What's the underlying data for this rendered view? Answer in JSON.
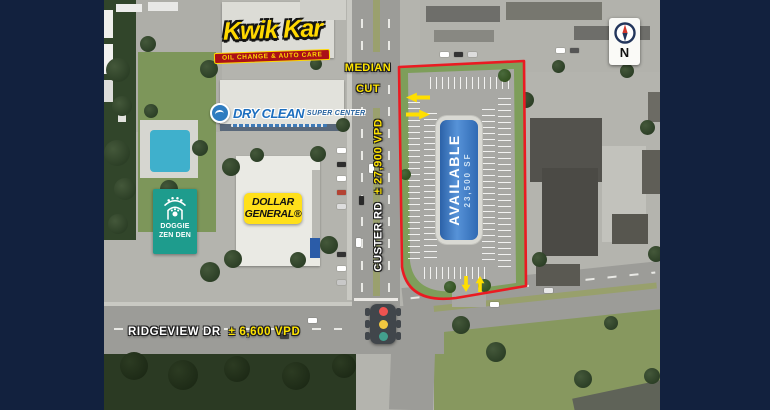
{
  "map_labels": {
    "kwik_kar": {
      "name": "Kwik Kar",
      "tagline": "OIL CHANGE & AUTO CARE"
    },
    "dry_clean": {
      "name": "DRY CLEAN",
      "subname": "SUPER CENTER"
    },
    "doggie_zen_den": {
      "line1": "DOGGIE",
      "line2": "ZEN DEN"
    },
    "dollar_general": {
      "line1": "DOLLAR",
      "line2": "GENERAL®"
    },
    "median_cut": {
      "line1": "MEDIAN",
      "line2": "CUT"
    },
    "custer_rd": {
      "name": "CUSTER RD",
      "vpd": "± 27,900 VPD"
    },
    "ridgeview_dr": {
      "name": "RIDGEVIEW DR",
      "vpd": "± 6,600 VPD"
    },
    "available_parcel": {
      "status": "AVAILABLE",
      "size": "23,500 SF"
    },
    "compass": {
      "n": "N"
    }
  },
  "icons": {
    "north_compass": "north-compass-icon",
    "traffic_light": "traffic-light-icon",
    "access_arrows": "yellow-directional-arrow-icons",
    "doggie_pagoda": "pagoda-paw-icon",
    "dry_clean_badge": "shirt-circle-icon"
  },
  "colors": {
    "frame_navy": "#12213E",
    "parcel_outline_red": "#EA1B22",
    "parcel_building_blue": "#3573BE",
    "highlight_yellow": "#FFE400",
    "dollar_general_yellow": "#FFE01A",
    "doggie_teal": "#1E9C8D",
    "kwik_red_banner": "#AB1017",
    "traffic_red": "#EF5350",
    "traffic_amber": "#F2C840",
    "traffic_green": "#43A08E"
  }
}
